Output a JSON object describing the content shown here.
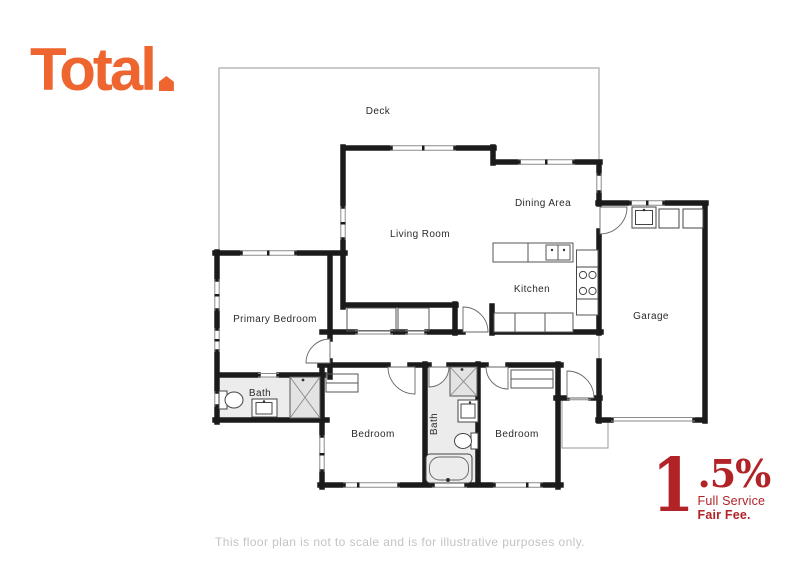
{
  "logo": {
    "text": "Total"
  },
  "plan": {
    "deck_label": "Deck",
    "living_label": "Living Room",
    "dining_label": "Dining Area",
    "kitchen_label": "Kitchen",
    "garage_label": "Garage",
    "primary_bedroom_label": "Primary Bedroom",
    "primary_bath_label": "Bath",
    "central_bath_label": "Bath",
    "bedroom_left_label": "Bedroom",
    "bedroom_right_label": "Bedroom"
  },
  "fee": {
    "numeral": "1",
    "fraction": ".5%",
    "line1": "Full Service",
    "line2": "Fair Fee."
  },
  "colors": {
    "brand_orange": "#EE6530",
    "fee_red": "#B22328",
    "wall_black": "#1b1b1b",
    "bath_floor_gray": "#ececec",
    "thin_line_gray": "#9a9a9a"
  },
  "disclaimer": "This floor plan is not to scale and is for illustrative purposes only."
}
